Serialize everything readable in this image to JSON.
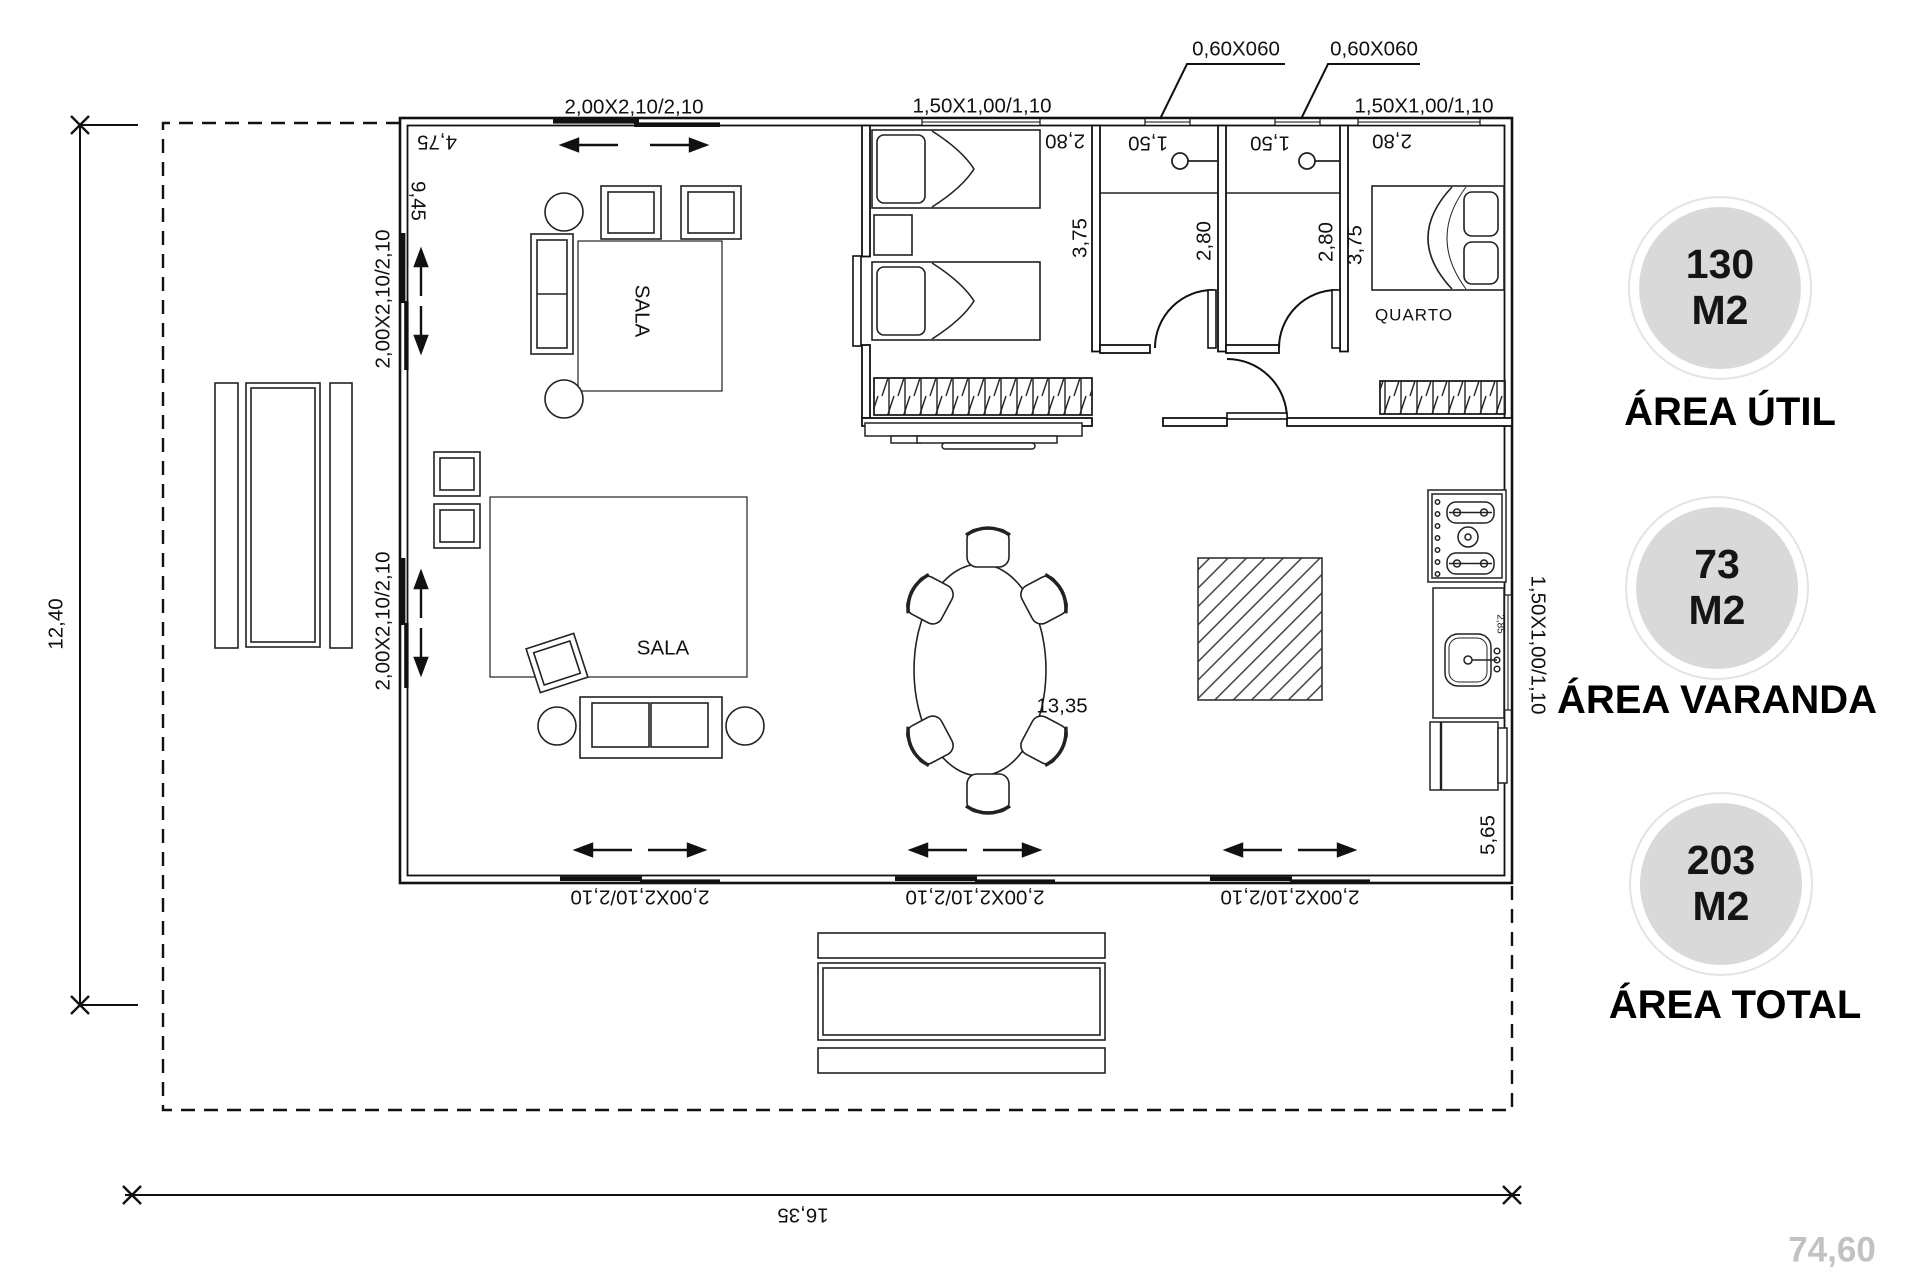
{
  "openings": {
    "door_top": "2,00X2,10/2,10",
    "door_left_upper": "2,00X2,10/2,10",
    "door_left_lower": "2,00X2,10/2,10",
    "door_bottom_1": "2,00X2,10/2,10",
    "door_bottom_2": "2,00X2,10/2,10",
    "door_bottom_3": "2,00X2,10/2,10",
    "window_bedroom": "1,50X1,00/1,10",
    "window_quarto": "1,50X1,00/1,10",
    "window_kitchen": "1,50X1,00/1,10",
    "window_bath1": "0,60X060",
    "window_bath2": "0,60X060"
  },
  "dimensions": {
    "sala_width": "4,75",
    "sala_depth": "9,45",
    "bedroom_width": "2,80",
    "bedroom_depth": "3,75",
    "bath1_width": "1,50",
    "bath1_depth": "2,80",
    "bath2_width": "1,50",
    "bath2_depth": "2,80",
    "quarto_width": "2,80",
    "quarto_depth": "3,75",
    "kitchen_counter": "2,85",
    "kitchen_side": "5,65",
    "living_width": "13,35",
    "plot_width": "16,35",
    "plot_height": "12,40",
    "corner_note": "74,60"
  },
  "rooms": {
    "sala_upper": "SALA",
    "sala_lower": "SALA",
    "quarto": "QUARTO"
  },
  "areas": [
    {
      "value": "130",
      "unit": "M2",
      "label": "ÁREA ÚTIL"
    },
    {
      "value": "73",
      "unit": "M2",
      "label": "ÁREA VARANDA"
    },
    {
      "value": "203",
      "unit": "M2",
      "label": "ÁREA TOTAL"
    }
  ],
  "colors": {
    "line": "#1a1a1a",
    "circle_fill": "#d9d9d9",
    "circle_ring": "#e3e3e3",
    "muted_text": "#c2c2c2"
  }
}
